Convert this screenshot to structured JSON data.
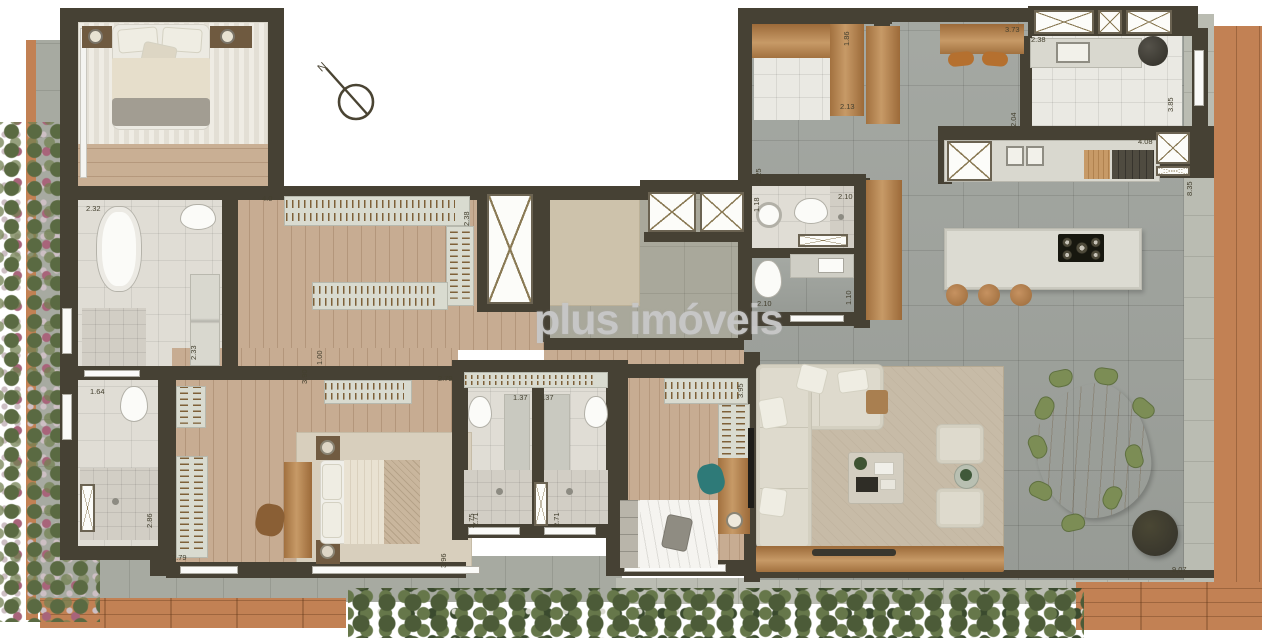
{
  "watermark": {
    "text": "plus imóveis",
    "color": "#c7c7c7"
  },
  "compass": {
    "label": "N"
  },
  "dims": [
    {
      "id": "bath1-width",
      "v": "2.32"
    },
    {
      "id": "bath1-depth",
      "v": "2.33"
    },
    {
      "id": "bath2-width",
      "v": "1.64"
    },
    {
      "id": "bath2-depth",
      "v": "2.86"
    },
    {
      "id": "closet-width",
      "v": "4.0"
    },
    {
      "id": "closet-depth",
      "v": "2.38"
    },
    {
      "id": "hall-opening",
      "v": "1.00"
    },
    {
      "id": "hall-depth",
      "v": "3.90"
    },
    {
      "id": "master-closet",
      "v": "2.79"
    },
    {
      "id": "master-west",
      "v": "2.79"
    },
    {
      "id": "master-depth",
      "v": "3.96"
    },
    {
      "id": "master-side",
      "v": "2.75"
    },
    {
      "id": "bath3-width",
      "v": "1.37"
    },
    {
      "id": "bath4-width",
      "v": "1.37"
    },
    {
      "id": "bath3-depth",
      "v": "2.71"
    },
    {
      "id": "bath4-depth",
      "v": "2.71"
    },
    {
      "id": "bedroom3-width",
      "v": "3.95"
    },
    {
      "id": "lav-width",
      "v": "1.18"
    },
    {
      "id": "lav-depth",
      "v": "2.10"
    },
    {
      "id": "bath5-width",
      "v": "2.10"
    },
    {
      "id": "bath5-depth",
      "v": "1.10"
    },
    {
      "id": "service-corr",
      "v": "1.25"
    },
    {
      "id": "service-depth",
      "v": "1.86"
    },
    {
      "id": "service-width",
      "v": "2.13"
    },
    {
      "id": "bar-width",
      "v": "3.73"
    },
    {
      "id": "kitchen-width",
      "v": "2.38"
    },
    {
      "id": "kitchen-left",
      "v": "2.04"
    },
    {
      "id": "kitchen-right",
      "v": "3.85"
    },
    {
      "id": "counter-width",
      "v": "4.08"
    },
    {
      "id": "terrace-depth",
      "v": "8.35"
    },
    {
      "id": "terrace-width",
      "v": "9,07"
    }
  ],
  "palette": {
    "wall": "#464134",
    "wood_floor": "#c9af94",
    "deck_wood": "#c28154",
    "gray_tile": "#9fa39d",
    "stone": "#a7aaa1",
    "white_tile": "#eae9e3",
    "living_rug": "#c7bba7",
    "sofa": "#dedacd",
    "dining_chair": "#7c8d55",
    "teal_chair": "#2e7a78",
    "dining_table": "#c68e51",
    "stool": "#b5702f",
    "watermark": "#c7c7c7"
  }
}
